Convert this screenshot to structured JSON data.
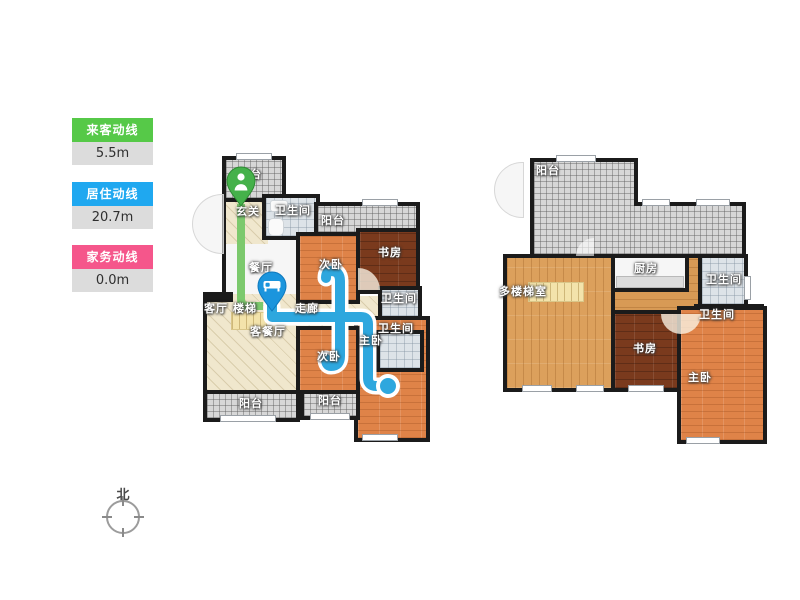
{
  "legend": {
    "items": [
      {
        "label": "来客动线",
        "value": "5.5m",
        "color": "#56c948"
      },
      {
        "label": "居住动线",
        "value": "20.7m",
        "color": "#1fa8f0"
      },
      {
        "label": "家务动线",
        "value": "0.0m",
        "color": "#f5568b"
      }
    ],
    "value_bg": "#dcdcdc"
  },
  "compass": {
    "north_label": "北"
  },
  "plans": {
    "left": {
      "labels": [
        {
          "text": "阳台"
        },
        {
          "text": "玄关"
        },
        {
          "text": "卫生间"
        },
        {
          "text": "阳台"
        },
        {
          "text": "次卧"
        },
        {
          "text": "书房"
        },
        {
          "text": "餐厅"
        },
        {
          "text": "客厅"
        },
        {
          "text": "楼梯"
        },
        {
          "text": "走廊"
        },
        {
          "text": "客餐厅"
        },
        {
          "text": "卫生间"
        },
        {
          "text": "卫生间"
        },
        {
          "text": "主卧"
        },
        {
          "text": "次卧"
        },
        {
          "text": "阳台"
        },
        {
          "text": "阳台"
        }
      ]
    },
    "right": {
      "labels": [
        {
          "text": "阳台"
        },
        {
          "text": "厨房"
        },
        {
          "text": "卫生间"
        },
        {
          "text": "多楼梯室"
        },
        {
          "text": "卫生间"
        },
        {
          "text": "书房"
        },
        {
          "text": "主卧"
        }
      ]
    }
  },
  "routes": {
    "visitor": {
      "color": "#7cc96d",
      "start_icon": "person-pin-icon"
    },
    "resident": {
      "color": "#2ea7de",
      "start_icon": "bed-pin-icon",
      "end_icon": "endpoint-dot"
    }
  },
  "colors": {
    "wall": "#1b1b1b",
    "wood": "#df8348",
    "wood_dark": "#7a3a1d",
    "wood_tan": "#dca05c",
    "tile_cream": "#f0e7cd",
    "tile_bath": "#dde3e8",
    "balcony_grey": "#d7d7d7"
  }
}
